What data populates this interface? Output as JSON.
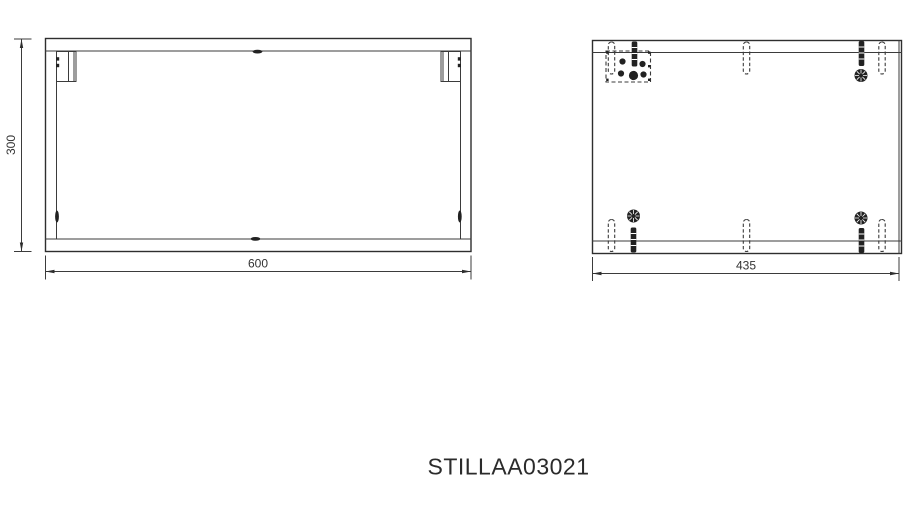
{
  "title": "STILLAA03021",
  "views": {
    "front": {
      "width": "600",
      "height": "300"
    },
    "side": {
      "depth": "435"
    }
  },
  "colors": {
    "line": "#3b3b3b",
    "background": "#ffffff",
    "text": "#333333"
  }
}
